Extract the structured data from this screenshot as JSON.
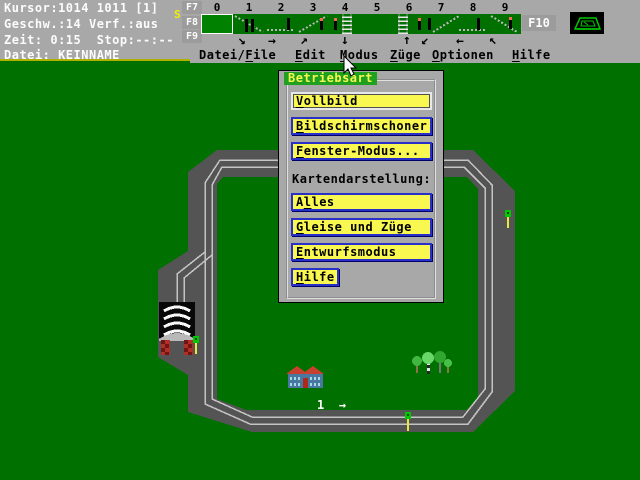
{
  "colors": {
    "map_green": "#007000",
    "header_gray": "#a8a8a8",
    "track_gray": "#545454",
    "rail_light": "#c4c4c4",
    "button_yellow": "#f8f850",
    "button_border_blue": "#2830c8",
    "title_green": "#1fa11f",
    "title_text_yellow": "#f8f850",
    "signal_green": "#00c800",
    "signal_pole_yellow": "#e8e840"
  },
  "status": {
    "line1": "Kursor:1014 1011 [1]",
    "line2": "Geschw.:14 Verf.:aus",
    "line3": "Zeit: 0:15  Stop:--:--",
    "line4": "Datei: KEINNAME",
    "signal_indicator": "S"
  },
  "toolbar": {
    "fkeys": [
      "F7",
      "F8",
      "F9"
    ],
    "f10_label": "F10",
    "digits": [
      "0",
      "1",
      "2",
      "3",
      "4",
      "5",
      "6",
      "7",
      "8",
      "9"
    ],
    "arrows": [
      "↘",
      "→",
      "↗",
      "↓",
      "↑",
      "↙",
      "←",
      "↖"
    ]
  },
  "menubar": {
    "items": [
      {
        "pre": "Datei/",
        "key": "F",
        "post": "ile"
      },
      {
        "pre": "",
        "key": "E",
        "post": "dit"
      },
      {
        "pre": "",
        "key": "M",
        "post": "odus"
      },
      {
        "pre": "",
        "key": "Z",
        "post": "üge"
      },
      {
        "pre": "",
        "key": "O",
        "post": "ptionen"
      },
      {
        "pre": "",
        "key": "H",
        "post": "ilfe"
      }
    ]
  },
  "dialog": {
    "title": "Betriebsart",
    "buttons": {
      "vollbild": {
        "pre": "",
        "key": "V",
        "post": "ollbild"
      },
      "bildschirmschoner": {
        "pre": "",
        "key": "B",
        "post": "ildschirmschoner"
      },
      "fenster": {
        "pre": "",
        "key": "F",
        "post": "enster-Modus..."
      },
      "alles": {
        "pre": "A",
        "key": "l",
        "post": "les"
      },
      "gleise": {
        "pre": "",
        "key": "G",
        "post": "leise und Züge"
      },
      "entwurf": {
        "pre": "",
        "key": "E",
        "post": "ntwurfsmodus"
      },
      "hilfe": {
        "pre": "",
        "key": "H",
        "post": "ilfe"
      }
    },
    "section_label": "Kartendarstellung:"
  },
  "map": {
    "platform_number": "1",
    "platform_arrow": "→"
  }
}
